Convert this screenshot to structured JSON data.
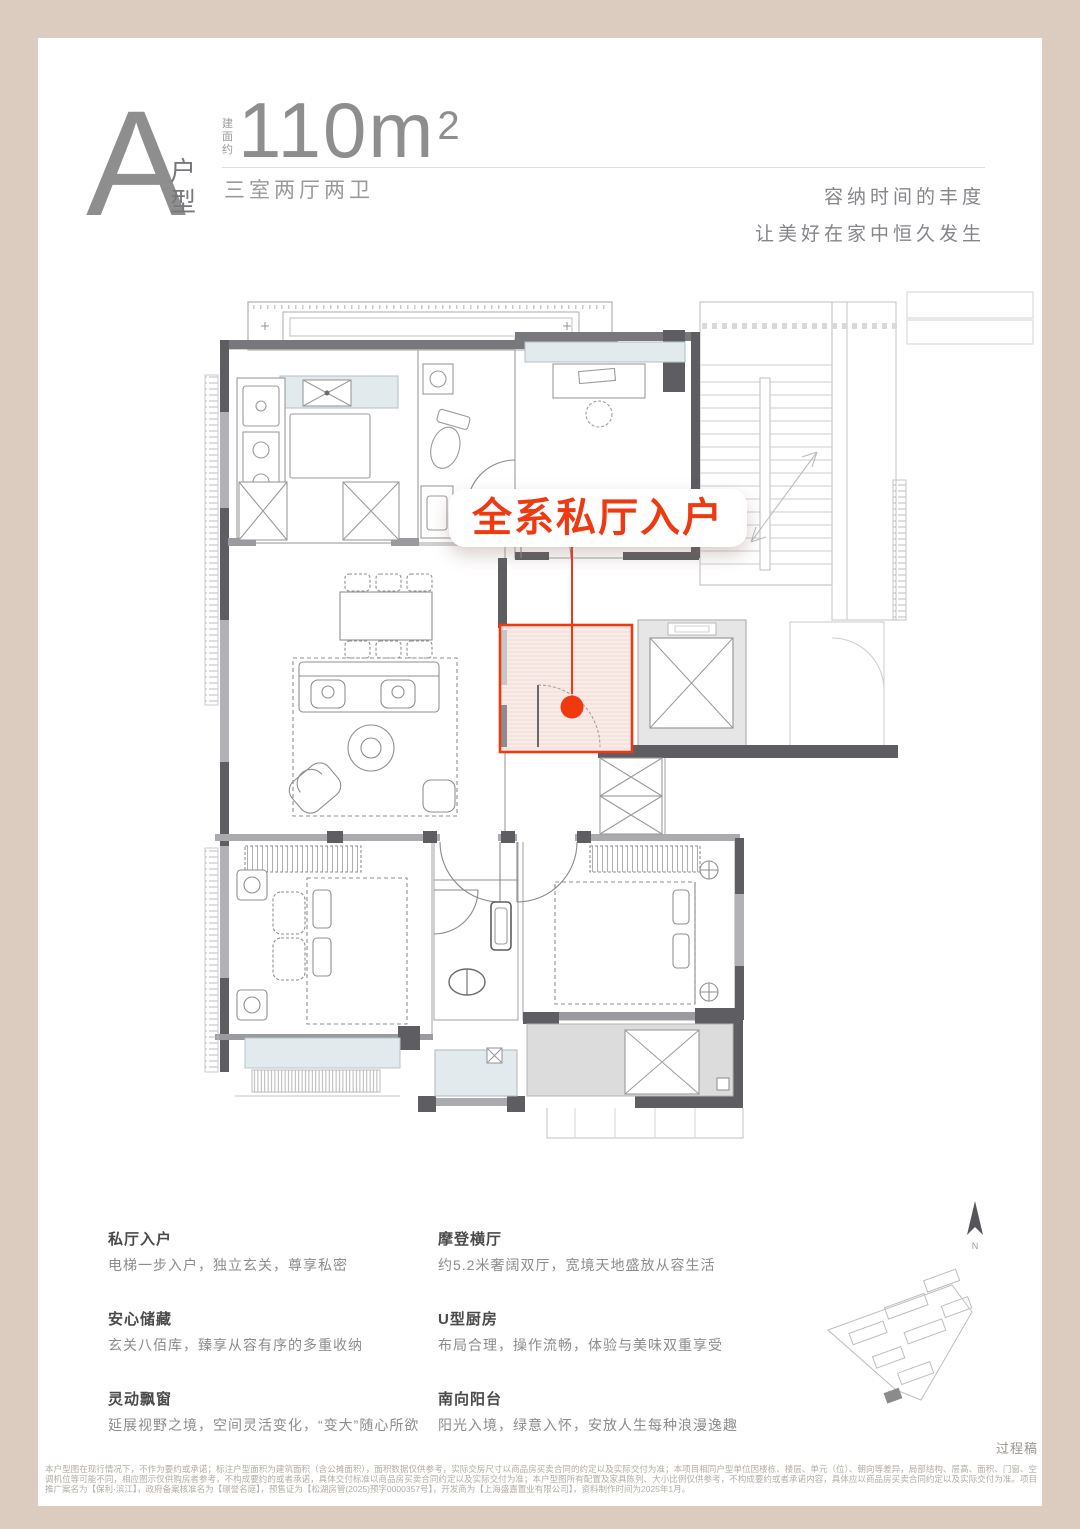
{
  "header": {
    "unit_letter": "A",
    "unit_type": "户型",
    "area_prefix": "建面约",
    "area_number": "110m",
    "area_exponent": "2",
    "layout": "三室两厅两卫",
    "slogan_1": "容纳时间的丰度",
    "slogan_2": "让美好在家中恒久发生"
  },
  "plan": {
    "callout": "全系私厅入户",
    "accent_color": "#ee3911",
    "highlight_room": "私厅入户玄关"
  },
  "features": {
    "left": [
      {
        "title": "私厅入户",
        "desc": "电梯一步入户，独立玄关，尊享私密"
      },
      {
        "title": "安心储藏",
        "desc": "玄关八佰库，臻享从容有序的多重收纳"
      },
      {
        "title": "灵动飘窗",
        "desc": "延展视野之境，空间灵活变化，“变大”随心所欲"
      }
    ],
    "right": [
      {
        "title": "摩登横厅",
        "desc": "约5.2米奢阔双厅，宽境天地盛放从容生活"
      },
      {
        "title": "U型厨房",
        "desc": "布局合理，操作流畅，体验与美味双重享受"
      },
      {
        "title": "南向阳台",
        "desc": "阳光入境，绿意入怀，安放人生每种浪漫逸趣"
      }
    ]
  },
  "footer": {
    "compass_n": "N",
    "draft_note": "过程稿",
    "disclaimer": "本户型图在现行情况下，不作为要约或承诺；标注户型面积为建筑面积（含公摊面积），面积数据仅供参考，实际交房尺寸以商品房买卖合同的约定以及实际交付为准；本项目相同户型单位因楼栋、楼层、单元（位）、朝向等差异，局部结构、层高、面积、门窗、空调机位等可能不同，相应图示仅供购房者参考，不构成要约的或者承诺，具体交付标准以商品房买卖合同约定以及实际交付为准；本户型图所有配置及家具陈列、大小比例仅供参考，不构成要约或者承诺内容，具体应以商品房买卖合同约定以及实际交付为准。项目推广案名为【保利·滨江】，政府备案核准名为【璟誉名庭】，预售证为【松湖房管(2025)预字0000357号】，开发商为【上海盛嘉置业有限公司】，资料制作时间为2025年1月。"
  },
  "colors": {
    "frame": "#dbccbf",
    "accent": "#ee3911",
    "wall": "#5d5d62"
  }
}
